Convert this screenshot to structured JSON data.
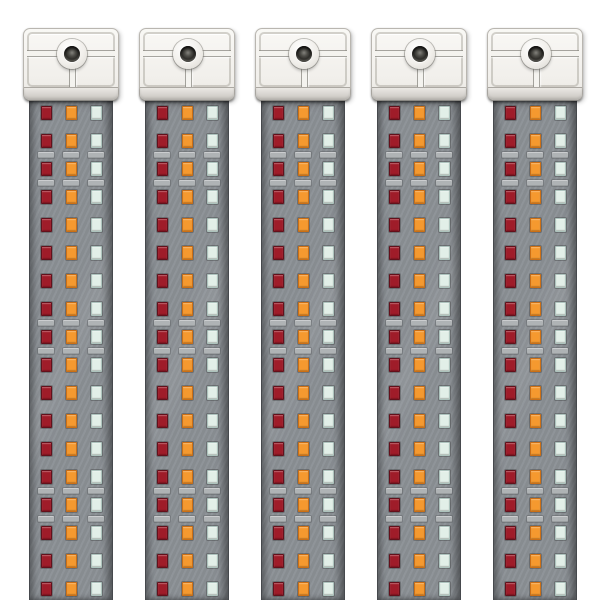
{
  "scene": {
    "type": "product-render",
    "description": "Five identical vertical LED grow-light strip bars on a white background. Each bar has a white square mounting bracket at the top with a central screw hole and T-shaped groove, a beveled bracket lip, and a gray aluminum strip body populated with rows of square LEDs in three columns (deep red, orange, cool white). Light gray solder pads appear between certain LED rows. Bars are cropped by the bottom edge of the image.",
    "background_color": "#ffffff",
    "bar_count": 5
  },
  "bar": {
    "bracket": {
      "face_color": "#f3f1ed",
      "ridge_color": "#f4f3ef",
      "lip_gradient_top": "#eae8e4",
      "lip_gradient_bottom": "#c6c3be",
      "screw_hole_color": "#35342f"
    },
    "body": {
      "color": "#8b9095",
      "edge_color": "#46494d"
    },
    "pad_color": "#afb3b5",
    "led_columns": [
      "deep-red",
      "orange",
      "cool-white"
    ],
    "led_colors": {
      "deep-red": {
        "fill": "#9f1c29",
        "border": "#64101b"
      },
      "orange": {
        "fill": "#f5992f",
        "border": "#cc6f14"
      },
      "cool-white": {
        "fill": "#e2efe8",
        "border": "#adc3bd"
      }
    },
    "led_rows_per_bar": 18,
    "leds_per_row": 3,
    "pad_rows_per_bar": 6,
    "row_sequence": [
      "led",
      "led",
      "pad",
      "led",
      "pad",
      "led",
      "led",
      "led",
      "led",
      "led",
      "pad",
      "led",
      "pad",
      "led",
      "led",
      "led",
      "led",
      "led",
      "pad",
      "led",
      "pad",
      "led",
      "led",
      "led"
    ]
  }
}
